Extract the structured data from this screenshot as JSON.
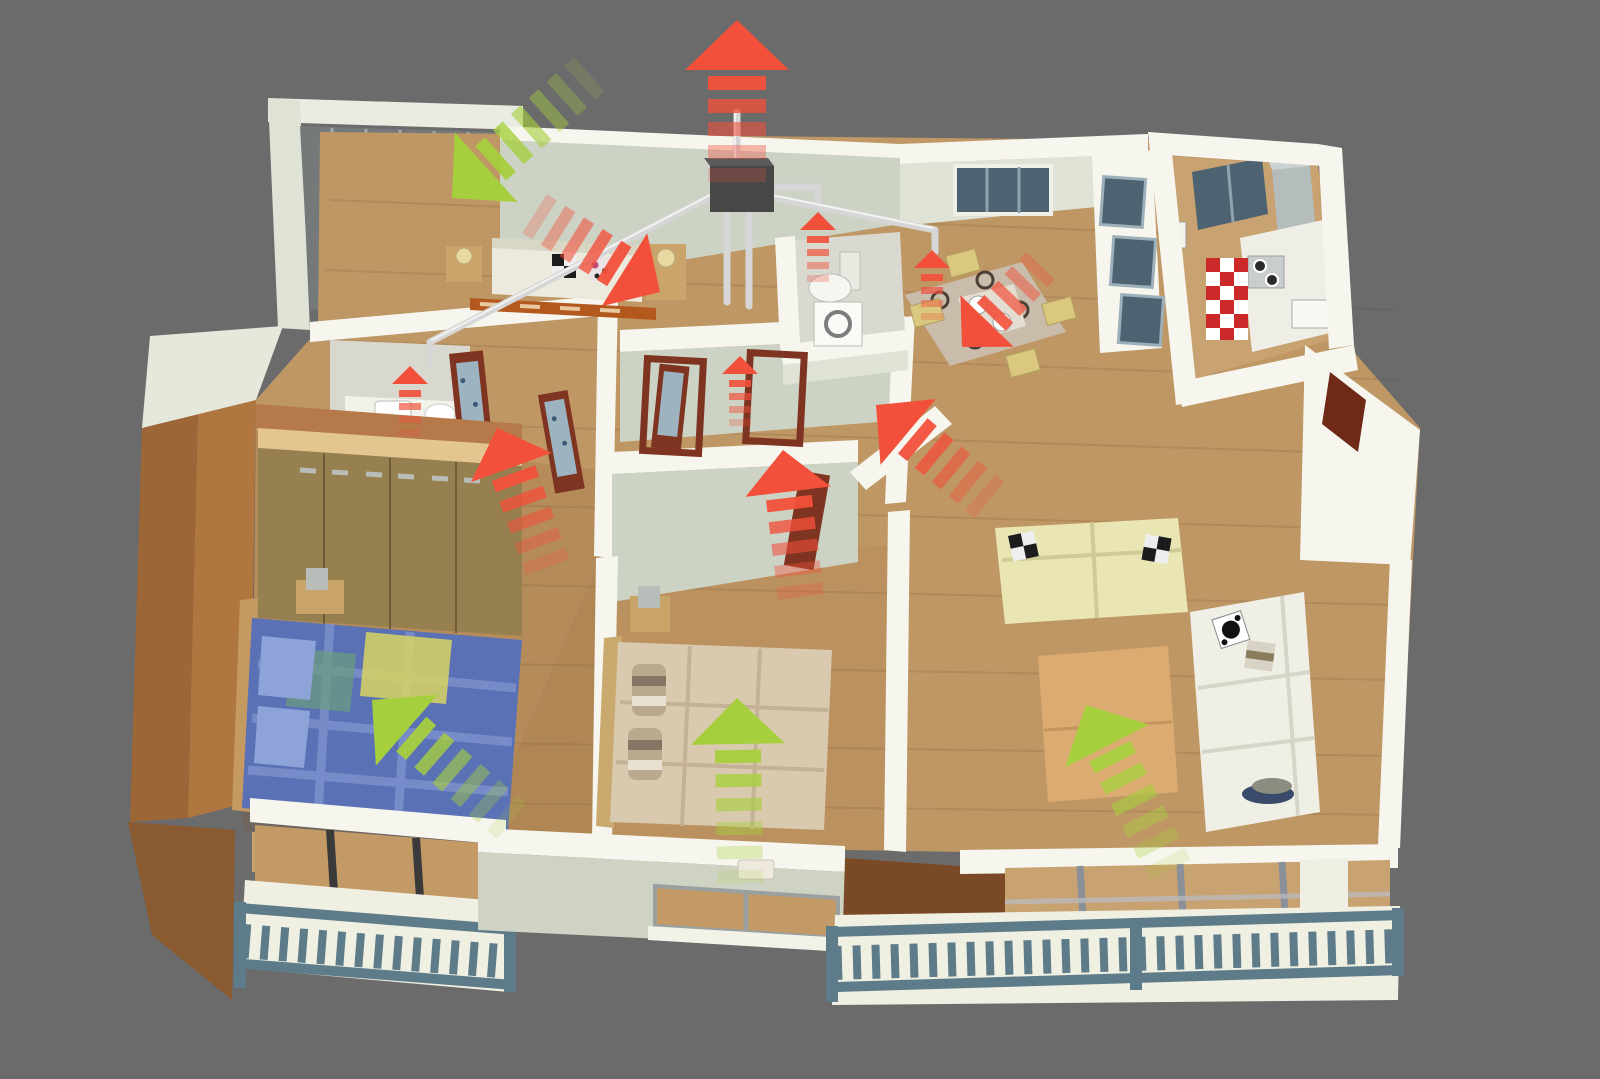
{
  "meta": {
    "alt": "3D cutaway floor plan of an apartment seen from above, with mechanical ventilation airflow arrows: green arrows show fresh supply air entering bedrooms and living room, red arrows show exhaust air collected from hall, bathroom, WC, dining and kitchen zones into ceiling ducts and expelled through the roof",
    "canvas": {
      "width": 1600,
      "height": 1079
    }
  },
  "palette": {
    "background": "#6b6b6b",
    "exhaust_red": "#f2503a",
    "supply_green": "#a6cf3e",
    "wall_top": "#f6f6ee",
    "wall_face": "#ccd3c5",
    "wall_face_light": "#dfe3d6",
    "floor_wood": "#bf9765",
    "floor_wood_light": "#c8a271",
    "west_wall_brown": "#b0763f",
    "west_wall_dark": "#9c6636",
    "accent_brown": "#b5794a",
    "divider_brown": "#7a4a26",
    "railing_slate": "#5d7b88",
    "balcony_floor": "#efefe2",
    "duct_silver": "#d6d6d6",
    "duct_unit_dark": "#474747",
    "door_wood": "#7e3420",
    "door_glass": "#9db4c0",
    "wardrobe_wood": "#97804f",
    "wardrobe_top": "#e3c68f",
    "bed_blue": "#5a71b5",
    "bed_beige": "#d9c9ae",
    "sofa_cream": "#e9e6b4",
    "sofa_white": "#efefe6",
    "table_wood": "#dcab72",
    "kitchen_tile_red": "#cc2a2a",
    "glazing_gray": "#75797a",
    "window_slate": "#4e6372"
  },
  "rooms": [
    {
      "id": "loggia-balcony"
    },
    {
      "id": "bedroom-top"
    },
    {
      "id": "bathroom"
    },
    {
      "id": "wc"
    },
    {
      "id": "hallway"
    },
    {
      "id": "bedroom-left"
    },
    {
      "id": "bedroom-center"
    },
    {
      "id": "dining-area"
    },
    {
      "id": "kitchen"
    },
    {
      "id": "entrance"
    },
    {
      "id": "living-room"
    },
    {
      "id": "balcony-front-left"
    },
    {
      "id": "balcony-front-right"
    }
  ],
  "airflow": {
    "presets": {
      "huge": {
        "head_len": 50,
        "head_w": 104,
        "dash_len": 14,
        "dash_w": 58,
        "gap": 9,
        "count": 5,
        "trail_opacity": [
          0.95,
          0.78,
          0.58,
          0.38,
          0.22
        ]
      },
      "big": {
        "head_len": 42,
        "head_w": 86,
        "dash_len": 12,
        "dash_w": 46,
        "gap": 10,
        "count": 5,
        "trail_opacity": [
          0.95,
          0.78,
          0.58,
          0.4,
          0.26
        ]
      },
      "med": {
        "head_len": 36,
        "head_w": 74,
        "dash_len": 11,
        "dash_w": 40,
        "gap": 9,
        "count": 4,
        "trail_opacity": [
          0.9,
          0.7,
          0.5,
          0.32
        ]
      },
      "small": {
        "head_len": 18,
        "head_w": 36,
        "dash_len": 7,
        "dash_w": 22,
        "gap": 6,
        "count": 4,
        "trail_opacity": [
          0.9,
          0.68,
          0.46,
          0.28
        ]
      },
      "supply": {
        "head_len": 46,
        "head_w": 94,
        "dash_len": 13,
        "dash_w": 46,
        "gap": 11,
        "count": 6,
        "trail_opacity": [
          0.95,
          0.8,
          0.62,
          0.45,
          0.3,
          0.16
        ]
      }
    },
    "arrows": [
      {
        "id": "exhaust-arrow-roof",
        "type": "exhaust",
        "x": 737,
        "y": 20,
        "angle": -90,
        "size": "huge"
      },
      {
        "id": "exhaust-arrow-bedroom-top",
        "type": "exhaust",
        "x": 660,
        "y": 292,
        "angle": 32,
        "size": "big"
      },
      {
        "id": "exhaust-arrow-wardrobe-hall",
        "type": "exhaust",
        "x": 497,
        "y": 428,
        "angle": -110,
        "size": "big"
      },
      {
        "id": "exhaust-arrow-center-hall",
        "type": "exhaust",
        "x": 783,
        "y": 450,
        "angle": -97,
        "size": "big"
      },
      {
        "id": "exhaust-arrow-living-to-hall",
        "type": "exhaust",
        "x": 876,
        "y": 405,
        "angle": -140,
        "size": "big"
      },
      {
        "id": "exhaust-arrow-dining",
        "type": "exhaust",
        "x": 962,
        "y": 347,
        "angle": 134,
        "size": "med"
      },
      {
        "id": "vent-arrow-bathroom",
        "type": "exhaust",
        "x": 410,
        "y": 366,
        "angle": -90,
        "size": "small"
      },
      {
        "id": "vent-arrow-hall-wall",
        "type": "exhaust",
        "x": 740,
        "y": 356,
        "angle": -90,
        "size": "small"
      },
      {
        "id": "vent-arrow-wc-near",
        "type": "exhaust",
        "x": 818,
        "y": 212,
        "angle": -90,
        "size": "small"
      },
      {
        "id": "vent-arrow-wc-far",
        "type": "exhaust",
        "x": 932,
        "y": 250,
        "angle": -90,
        "size": "small"
      },
      {
        "id": "supply-arrow-bedroom-top",
        "type": "supply",
        "x": 452,
        "y": 198,
        "angle": 138,
        "size": "supply"
      },
      {
        "id": "supply-arrow-bedroom-left",
        "type": "supply",
        "x": 372,
        "y": 700,
        "angle": -139,
        "size": "supply"
      },
      {
        "id": "supply-arrow-bedroom-center",
        "type": "supply",
        "x": 737,
        "y": 698,
        "angle": -91,
        "size": "supply"
      },
      {
        "id": "supply-arrow-living",
        "type": "supply",
        "x": 1086,
        "y": 705,
        "angle": -117,
        "size": "supply"
      }
    ]
  },
  "ventilation_unit": {
    "id": "heat-recovery-unit"
  }
}
